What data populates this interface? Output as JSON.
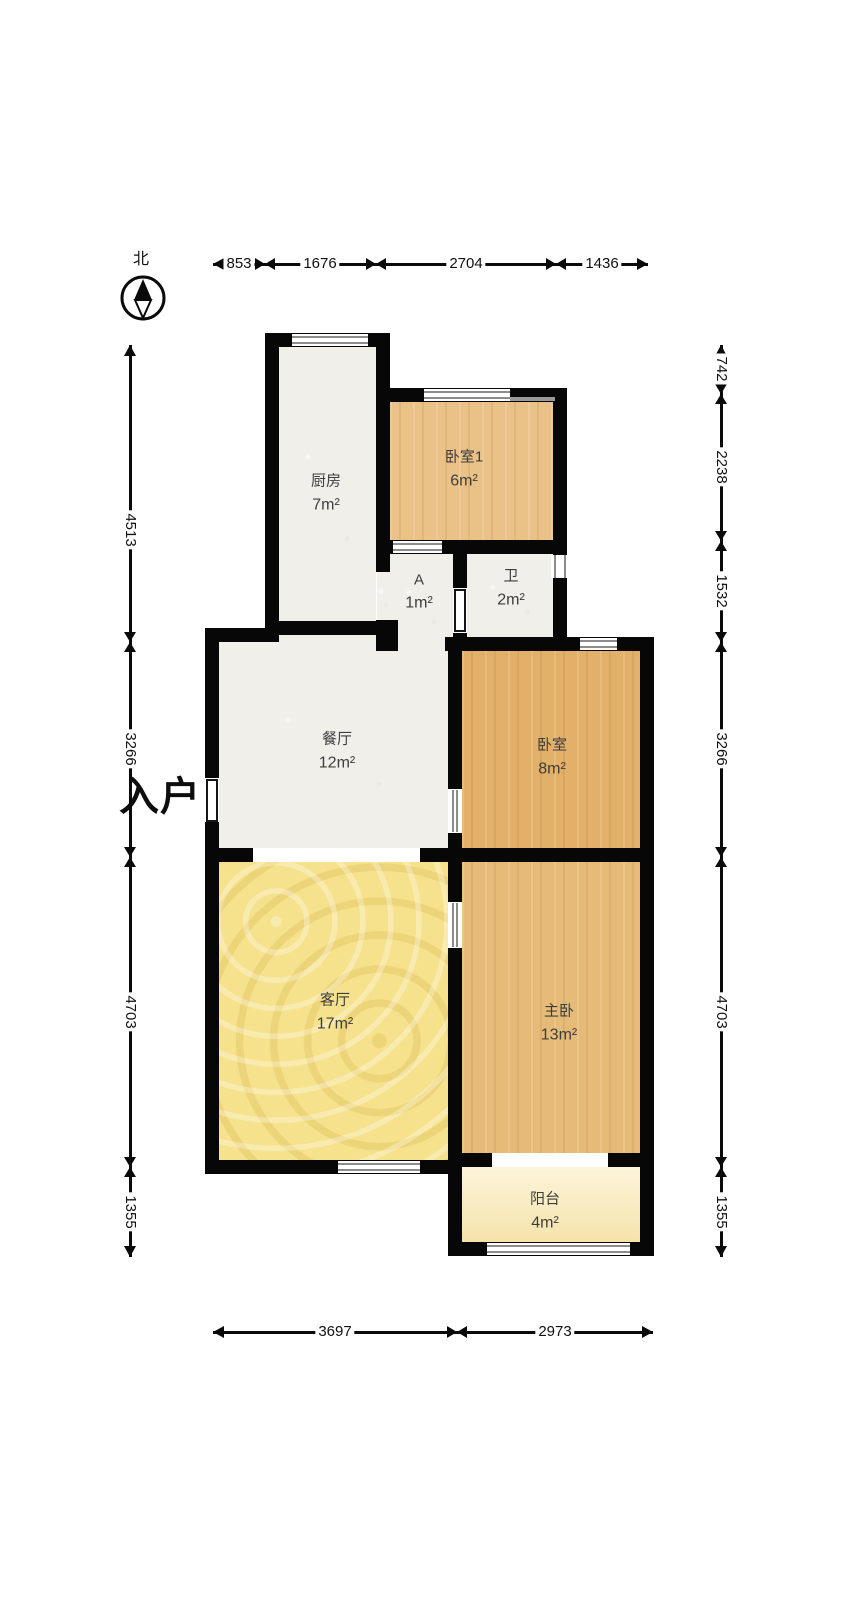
{
  "compass": {
    "north_label": "北"
  },
  "entrance": {
    "label": "入户"
  },
  "rooms": [
    {
      "id": "kitchen",
      "name": "厨房",
      "area": "7m²"
    },
    {
      "id": "bedroom1",
      "name": "卧室1",
      "area": "6m²"
    },
    {
      "id": "hall-a",
      "name": "A",
      "area": "1m²"
    },
    {
      "id": "bathroom",
      "name": "卫",
      "area": "2m²"
    },
    {
      "id": "dining",
      "name": "餐厅",
      "area": "12m²"
    },
    {
      "id": "bedroom",
      "name": "卧室",
      "area": "8m²"
    },
    {
      "id": "living",
      "name": "客厅",
      "area": "17m²"
    },
    {
      "id": "master",
      "name": "主卧",
      "area": "13m²"
    },
    {
      "id": "balcony",
      "name": "阳台",
      "area": "4m²"
    }
  ],
  "dimensions_mm": {
    "top": [
      "853",
      "1676",
      "2704",
      "1436"
    ],
    "bottom": [
      "3697",
      "2973"
    ],
    "left": [
      "4513",
      "3266",
      "4703",
      "1355"
    ],
    "right": [
      "742",
      "2238",
      "1532",
      "3266",
      "4703",
      "1355"
    ]
  },
  "colors": {
    "wall": "#070707",
    "wood_floor": "#e6bb77",
    "living_floor": "#f6e28c",
    "tile_floor": "#f1efe9",
    "balcony_floor": "#f8ebc4",
    "background": "#ffffff"
  }
}
